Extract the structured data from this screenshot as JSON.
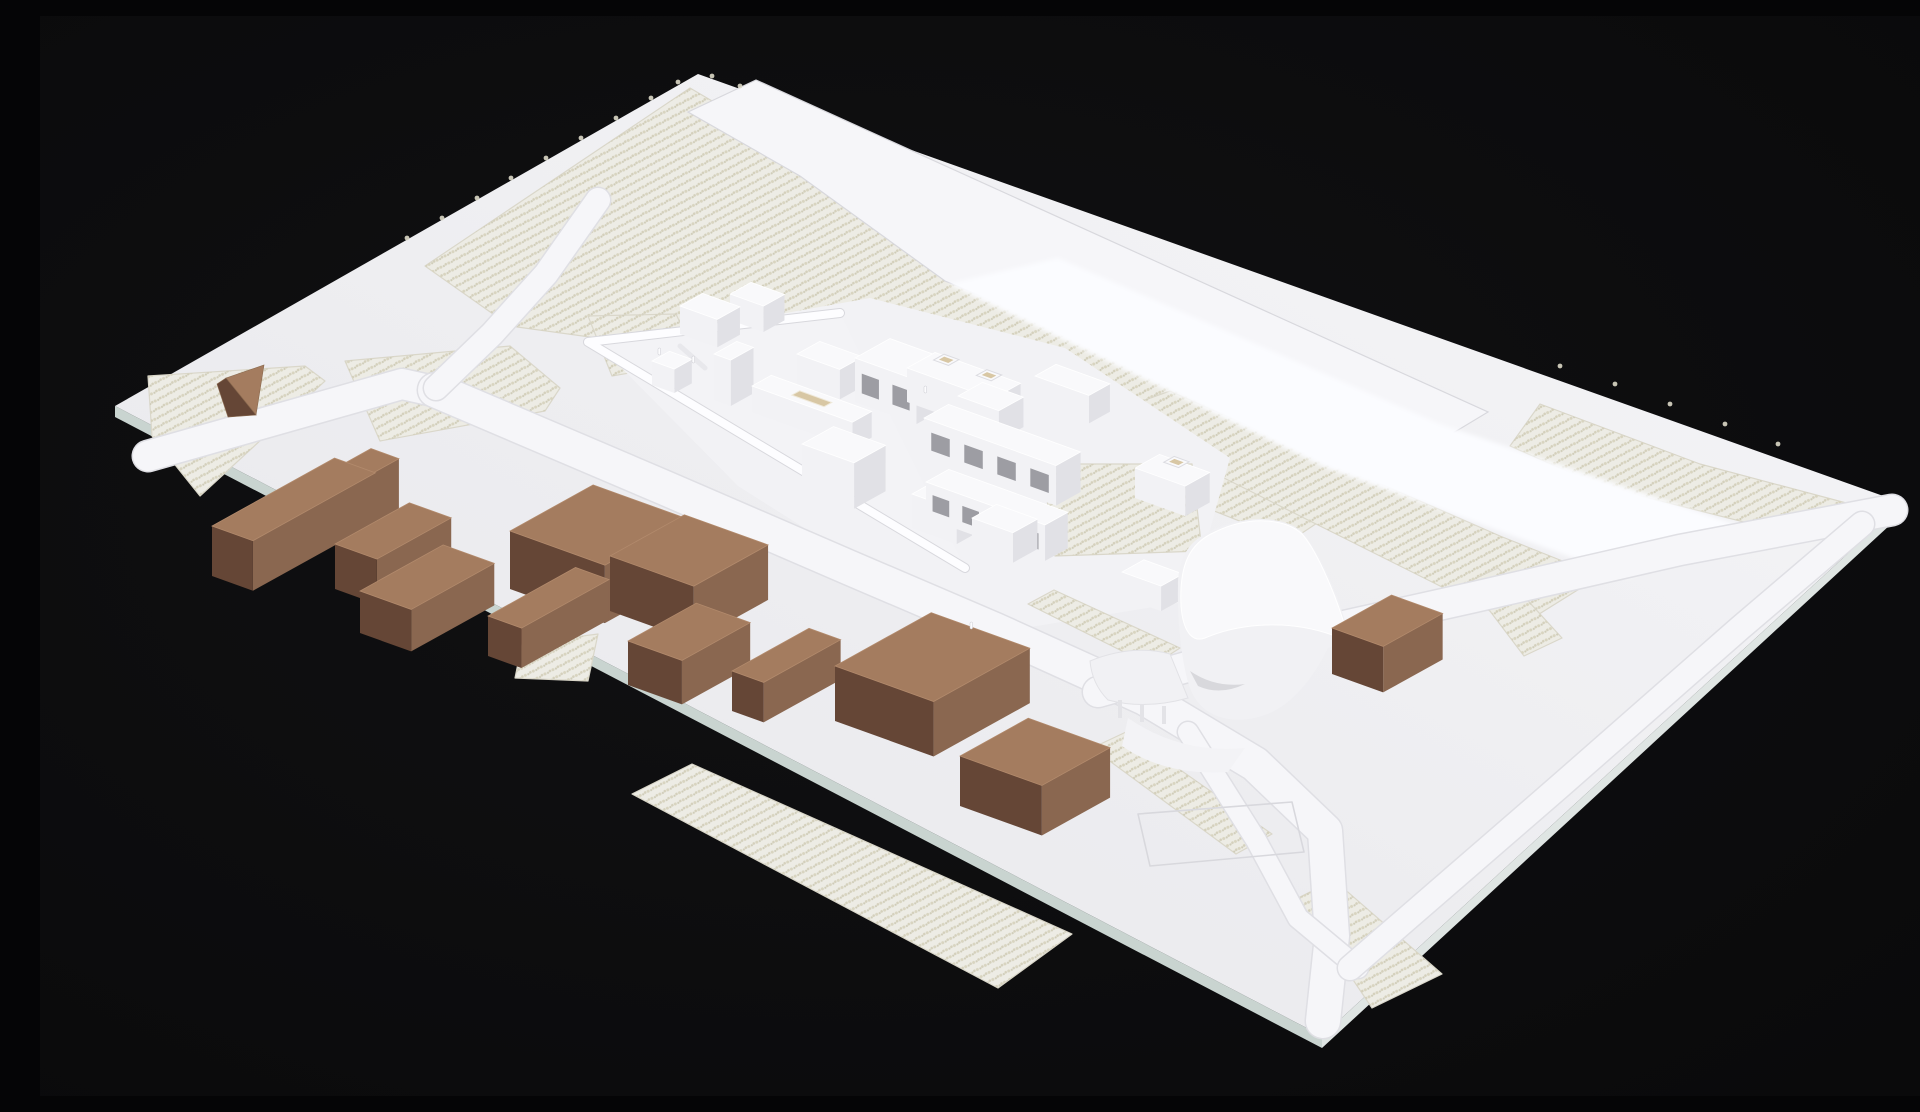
{
  "meta": {
    "description": "Photograph of a white architectural site model on a black background: a tilted rectangular baseboard with textured vineyard fields, roads, a white felt stream band, a cluster of white massing buildings with a triangular walled courtyard and a tall curved sail-shaped landmark building, surrounded by brown cardboard context building blocks.",
    "type": "photograph-of-physical-model"
  },
  "palette": {
    "background": "#0a0a0b",
    "background_center": "#111113",
    "board_dim": "#e6e6ea",
    "board_mid": "#efeff2",
    "board_bright": "#f6f6f8",
    "board_edge_front": "#c9d4d0",
    "board_edge_right": "#dfe5e3",
    "road_fill": "#f6f6f9",
    "road_casing": "#dfdfe4",
    "incision_line": "#d8d8dd",
    "vineyard_base": "#edece5",
    "vineyard_dot_a": "#d8d4c0",
    "vineyard_dot_b": "#cfccb8",
    "vineyard_dot_c": "#d4d0bc",
    "vineyard_outline": "#dad7ca",
    "felt_band": "#fbfcff",
    "plinth": "#f2f2f5",
    "wedge_floor": "#f3f3f6",
    "wedge_wall": "#fdfdff",
    "white_top": "#f9f9fb",
    "white_sw": "#f2f2f5",
    "white_se": "#e1e1e6",
    "white_window": "#9d9da3",
    "tan_reveal": "#d8c7a4",
    "brown_top": "#a47c5f",
    "brown_sw": "#654636",
    "brown_se": "#8a6750",
    "figure": "#fcfcfe",
    "fringe": "#dcd8c7"
  },
  "scene": {
    "board": {
      "corners": [
        [
          75,
          390
        ],
        [
          658,
          58
        ],
        [
          1863,
          487
        ],
        [
          1282,
          1020
        ]
      ]
    },
    "board_edges": [
      {
        "name": "board-edge-front",
        "pts": [
          [
            75,
            390
          ],
          [
            1282,
            1020
          ],
          [
            1282,
            1032
          ],
          [
            75,
            401
          ]
        ],
        "fill": "board_edge_front"
      },
      {
        "name": "board-edge-right",
        "pts": [
          [
            1282,
            1020
          ],
          [
            1863,
            487
          ],
          [
            1863,
            497
          ],
          [
            1282,
            1032
          ]
        ],
        "fill": "board_edge_right"
      }
    ],
    "vineyards": [
      {
        "name": "vineyard-upper-slope",
        "pts": [
          [
            385,
            250
          ],
          [
            650,
            72
          ],
          [
            1330,
            472
          ],
          [
            1250,
            525
          ],
          [
            1010,
            430
          ],
          [
            760,
            350
          ],
          [
            470,
            310
          ]
        ]
      },
      {
        "name": "vineyard-right-of-stream",
        "pts": [
          [
            1060,
            400
          ],
          [
            1130,
            375
          ],
          [
            1460,
            520
          ],
          [
            1560,
            560
          ],
          [
            1480,
            610
          ],
          [
            1300,
            520
          ]
        ]
      },
      {
        "name": "vineyard-right-corner",
        "pts": [
          [
            1500,
            388
          ],
          [
            1660,
            448
          ],
          [
            1810,
            488
          ],
          [
            1760,
            520
          ],
          [
            1560,
            470
          ],
          [
            1470,
            430
          ]
        ]
      },
      {
        "name": "vineyard-left-tip",
        "pts": [
          [
            108,
            360
          ],
          [
            265,
            350
          ],
          [
            285,
            365
          ],
          [
            160,
            480
          ],
          [
            112,
            420
          ]
        ]
      },
      {
        "name": "vineyard-left-wedge",
        "pts": [
          [
            305,
            345
          ],
          [
            470,
            330
          ],
          [
            520,
            372
          ],
          [
            505,
            395
          ],
          [
            340,
            425
          ]
        ]
      },
      {
        "name": "vineyard-left-small",
        "pts": [
          [
            548,
            300
          ],
          [
            636,
            298
          ],
          [
            658,
            345
          ],
          [
            572,
            360
          ]
        ]
      },
      {
        "name": "vineyard-bottom-small",
        "pts": [
          [
            482,
            628
          ],
          [
            558,
            618
          ],
          [
            548,
            665
          ],
          [
            475,
            662
          ]
        ]
      },
      {
        "name": "vineyard-bottom-long",
        "pts": [
          [
            592,
            778
          ],
          [
            652,
            748
          ],
          [
            1032,
            918
          ],
          [
            958,
            972
          ]
        ]
      },
      {
        "name": "vineyard-bottom-right-1",
        "pts": [
          [
            1052,
            732
          ],
          [
            1086,
            716
          ],
          [
            1232,
            818
          ],
          [
            1196,
            838
          ]
        ]
      },
      {
        "name": "vineyard-bottom-right-2",
        "pts": [
          [
            1258,
            882
          ],
          [
            1294,
            864
          ],
          [
            1402,
            958
          ],
          [
            1332,
            992
          ]
        ]
      },
      {
        "name": "vineyard-east-small",
        "pts": [
          [
            1428,
            566
          ],
          [
            1458,
            552
          ],
          [
            1522,
            622
          ],
          [
            1484,
            640
          ]
        ]
      }
    ],
    "vineyards_over": [
      {
        "name": "vineyard-site-garden",
        "pts": [
          [
            1002,
            448
          ],
          [
            1152,
            448
          ],
          [
            1162,
            535
          ],
          [
            1015,
            540
          ]
        ]
      },
      {
        "name": "vineyard-site-strip",
        "pts": [
          [
            988,
            588
          ],
          [
            1014,
            574
          ],
          [
            1140,
            632
          ],
          [
            1112,
            650
          ]
        ]
      }
    ],
    "plinth": {
      "name": "site-plinth",
      "pts": [
        [
          560,
          330
        ],
        [
          830,
          282
        ],
        [
          1025,
          332
        ],
        [
          1190,
          442
        ],
        [
          1150,
          585
        ],
        [
          935,
          620
        ],
        [
          698,
          470
        ]
      ]
    },
    "top_road": {
      "name": "upper-hillside-road",
      "pts": [
        [
          648,
          96
        ],
        [
          716,
          64
        ],
        [
          1448,
          396
        ],
        [
          1355,
          452
        ],
        [
          905,
          265
        ],
        [
          760,
          160
        ]
      ]
    },
    "felt": {
      "name": "stream-felt-band",
      "pts": [
        [
          908,
          268
        ],
        [
          1018,
          242
        ],
        [
          1400,
          408
        ],
        [
          1706,
          512
        ],
        [
          1588,
          562
        ],
        [
          1286,
          452
        ]
      ]
    },
    "roads": [
      {
        "name": "road-left-approach",
        "pts": [
          [
            108,
            440
          ],
          [
            362,
            368
          ],
          [
            398,
            376
          ]
        ],
        "width": 30
      },
      {
        "name": "road-main-street",
        "pts": [
          [
            395,
            374
          ],
          [
            625,
            472
          ],
          [
            810,
            552
          ],
          [
            955,
            614
          ],
          [
            1105,
            682
          ],
          [
            1215,
            748
          ],
          [
            1285,
            815
          ],
          [
            1292,
            920
          ],
          [
            1283,
            1005
          ]
        ],
        "width": 34
      },
      {
        "name": "road-upper-branch",
        "pts": [
          [
            558,
            184
          ],
          [
            506,
            258
          ],
          [
            452,
            318
          ],
          [
            396,
            372
          ]
        ],
        "width": 24
      },
      {
        "name": "road-east-valley",
        "pts": [
          [
            1058,
            676
          ],
          [
            1250,
            622
          ],
          [
            1430,
            582
          ],
          [
            1640,
            534
          ],
          [
            1852,
            494
          ]
        ],
        "width": 30
      },
      {
        "name": "road-south-spur",
        "pts": [
          [
            1148,
            716
          ],
          [
            1216,
            824
          ],
          [
            1258,
            902
          ],
          [
            1318,
            952
          ]
        ],
        "width": 20
      },
      {
        "name": "road-southeast-edge",
        "pts": [
          [
            1310,
            952
          ],
          [
            1520,
            770
          ],
          [
            1700,
            612
          ],
          [
            1822,
            508
          ]
        ],
        "width": 24
      }
    ],
    "parking": [
      {
        "name": "parking-incision",
        "pts": [
          [
            1098,
            798
          ],
          [
            1252,
            786
          ],
          [
            1264,
            836
          ],
          [
            1110,
            850
          ]
        ]
      }
    ],
    "courtyard": {
      "floor": {
        "name": "courtyard-wedge-floor",
        "pts": [
          [
            548,
            326
          ],
          [
            800,
            297
          ],
          [
            925,
            552
          ]
        ]
      },
      "wall_path": [
        [
          800,
          297
        ],
        [
          548,
          326
        ],
        [
          925,
          552
        ]
      ],
      "partitions": [
        [
          [
            640,
            330
          ],
          [
            665,
            352
          ]
        ],
        [
          [
            700,
            362
          ],
          [
            740,
            396
          ]
        ]
      ]
    },
    "white_buildings": [
      {
        "name": "white-building-nw-1",
        "p": [
          640,
          290
        ],
        "u": 40,
        "v": 26,
        "h": 28
      },
      {
        "name": "white-building-nw-2",
        "p": [
          690,
          278
        ],
        "u": 36,
        "v": 24,
        "h": 26
      },
      {
        "name": "white-building-slab",
        "p": [
          674,
          338
        ],
        "u": 18,
        "v": 26,
        "h": 46
      },
      {
        "name": "white-building-court-box",
        "p": [
          612,
          345
        ],
        "u": 24,
        "v": 20,
        "h": 24
      },
      {
        "name": "white-building-mid-pair",
        "p": [
          757,
          338
        ],
        "u": 46,
        "v": 26,
        "h": 30
      },
      {
        "name": "white-building-big-box",
        "p": [
          815,
          342
        ],
        "u": 66,
        "v": 40,
        "h": 44,
        "windows": 2
      },
      {
        "name": "white-building-low-bar",
        "p": [
          712,
          370
        ],
        "u": 108,
        "v": 22,
        "h": 26,
        "roofTan": true
      },
      {
        "name": "white-building-rounded",
        "p": [
          762,
          428
        ],
        "u": 56,
        "v": 36,
        "h": 46
      },
      {
        "name": "white-building-terrace-house",
        "p": [
          867,
          352
        ],
        "u": 92,
        "v": 32,
        "h": 34,
        "roofBoxes": 2
      },
      {
        "name": "white-building-gable-house",
        "p": [
          995,
          360
        ],
        "u": 58,
        "v": 24,
        "h": 28
      },
      {
        "name": "white-building-mid-right",
        "p": [
          918,
          380
        ],
        "u": 44,
        "v": 28,
        "h": 30
      },
      {
        "name": "white-building-row-upper",
        "p": [
          884,
          402
        ],
        "u": 142,
        "v": 28,
        "h": 40,
        "windows": 4
      },
      {
        "name": "white-building-row-lower",
        "p": [
          886,
          466
        ],
        "u": 128,
        "v": 26,
        "h": 36,
        "windows": 4
      },
      {
        "name": "white-building-roof-opening",
        "p": [
          872,
          478
        ],
        "u": 48,
        "v": 32,
        "h": 34,
        "roofTan": true
      },
      {
        "name": "white-building-small-box",
        "p": [
          932,
          502
        ],
        "u": 44,
        "v": 28,
        "h": 30
      },
      {
        "name": "white-building-east-house",
        "p": [
          1095,
          452
        ],
        "u": 54,
        "v": 28,
        "h": 30,
        "roofBoxes": 1
      },
      {
        "name": "white-building-kiosk",
        "p": [
          1082,
          556
        ],
        "u": 42,
        "v": 25,
        "h": 25
      }
    ],
    "sail": {
      "name": "sail-landmark-building",
      "silhouette": "M 1138 570 C 1138 535 1155 520 1180 511 C 1215 497 1250 503 1263 517 C 1280 536 1298 580 1306 608 C 1310 620 1300 628 1288 632 C 1270 668 1248 692 1222 700 C 1190 710 1160 700 1150 672 C 1142 650 1137 605 1138 570 Z",
      "top_surface": "M 1141 590 C 1139 548 1150 527 1175 516 C 1212 498 1248 504 1262 518 C 1275 532 1293 572 1303 604 C 1306 613 1303 618 1295 620 C 1250 603 1200 607 1165 622 C 1152 627 1143 615 1141 590 Z",
      "undercut": "M 1150 655 Q 1175 672 1205 668 Q 1180 680 1158 670 Z",
      "wing": "M 1050 645 Q 1092 628 1130 638 L 1148 682 Q 1105 694 1068 684 Q 1052 668 1050 645 Z",
      "ramp": "M 1088 702 Q 1140 738 1205 732 L 1188 756 Q 1125 760 1082 730 Z",
      "columns": [
        [
          1078,
          684
        ],
        [
          1100,
          688
        ],
        [
          1122,
          690
        ]
      ]
    },
    "brown_buildings": [
      {
        "name": "brown-block-long-L",
        "p": [
          172,
          510
        ],
        "u": 44,
        "v": 140,
        "h": 50
      },
      {
        "name": "brown-block-long-L-arm",
        "p": [
          296,
          452
        ],
        "u": 30,
        "v": 40,
        "h": 50
      },
      {
        "name": "brown-block-2",
        "p": [
          295,
          528
        ],
        "u": 45,
        "v": 85,
        "h": 45
      },
      {
        "name": "brown-block-3",
        "p": [
          320,
          575
        ],
        "u": 55,
        "v": 95,
        "h": 42
      },
      {
        "name": "brown-block-thin",
        "p": [
          448,
          600
        ],
        "u": 36,
        "v": 100,
        "h": 40
      },
      {
        "name": "brown-block-big-1",
        "p": [
          470,
          515
        ],
        "u": 102,
        "v": 95,
        "h": 58
      },
      {
        "name": "brown-block-big-2",
        "p": [
          570,
          540
        ],
        "u": 90,
        "v": 85,
        "h": 55
      },
      {
        "name": "brown-block-notch",
        "p": [
          588,
          625
        ],
        "u": 58,
        "v": 78,
        "h": 44
      },
      {
        "name": "brown-block-channel",
        "p": [
          692,
          655
        ],
        "u": 34,
        "v": 88,
        "h": 40
      },
      {
        "name": "brown-block-large",
        "p": [
          795,
          650
        ],
        "u": 106,
        "v": 110,
        "h": 55
      },
      {
        "name": "brown-block-square",
        "p": [
          920,
          740
        ],
        "u": 88,
        "v": 78,
        "h": 50
      },
      {
        "name": "brown-block-east-notched",
        "p": [
          1292,
          612
        ],
        "u": 55,
        "v": 68,
        "h": 46
      }
    ],
    "hut": [
      {
        "name": "triangular-hut-top",
        "pts": [
          [
            186,
            362
          ],
          [
            224,
            349
          ],
          [
            216,
            399
          ]
        ],
        "fill": "brown_top"
      },
      {
        "name": "triangular-hut-side",
        "pts": [
          [
            177,
            368
          ],
          [
            186,
            362
          ],
          [
            216,
            399
          ],
          [
            188,
            401
          ]
        ],
        "fill": "brown_sw"
      }
    ],
    "figures": [
      [
        618,
        332
      ],
      [
        652,
        340
      ],
      [
        884,
        370
      ],
      [
        930,
        606
      ]
    ],
    "fringe_dots": [
      [
        367,
        222
      ],
      [
        402,
        202
      ],
      [
        437,
        182
      ],
      [
        471,
        162
      ],
      [
        506,
        142
      ],
      [
        541,
        122
      ],
      [
        576,
        102
      ],
      [
        611,
        82
      ],
      [
        638,
        66
      ],
      [
        672,
        60
      ],
      [
        700,
        70
      ],
      [
        1520,
        350
      ],
      [
        1575,
        368
      ],
      [
        1630,
        388
      ],
      [
        1685,
        408
      ],
      [
        1738,
        428
      ]
    ]
  }
}
